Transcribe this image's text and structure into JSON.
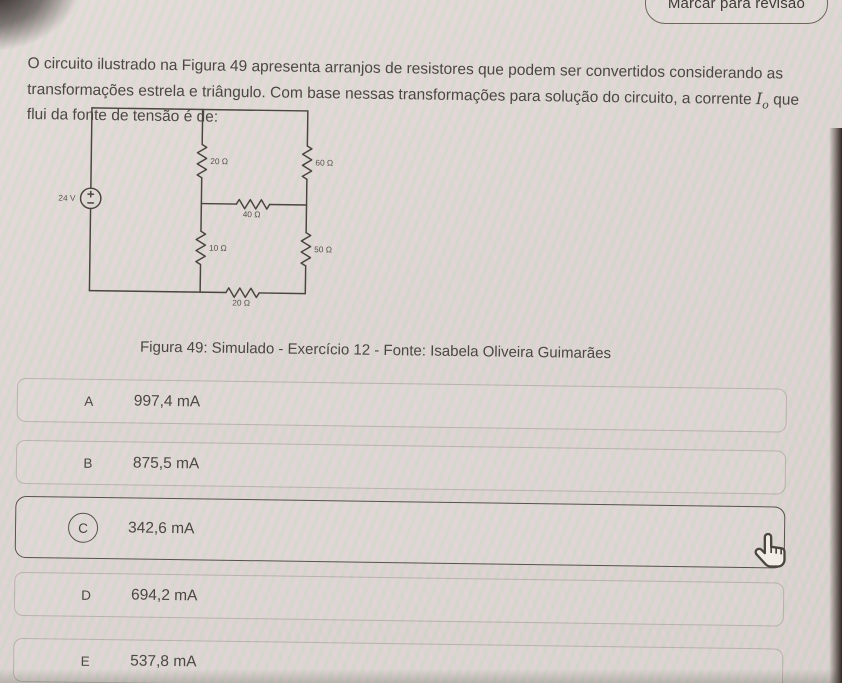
{
  "header": {
    "review_button_label": "Marcar para revisão"
  },
  "question": {
    "text_main": "O circuito ilustrado na Figura 49 apresenta arranjos de resistores que podem ser convertidos considerando as transformações estrela e triângulo. Com base nessas transformações para solução do circuito, a corrente",
    "current_symbol": "I",
    "current_subscript": "o",
    "text_end": "que flui da fonte de tensão é de:"
  },
  "figure": {
    "source_label": "24 V",
    "resistors": {
      "top_middle": "20 Ω",
      "top_right": "60 Ω",
      "middle": "40 Ω",
      "bottom_middle": "10 Ω",
      "bottom_right": "50 Ω",
      "bottom": "20 Ω"
    },
    "caption": "Figura 49: Simulado - Exercício 12 - Fonte: Isabela Oliveira Guimarães"
  },
  "options": [
    {
      "letter": "A",
      "value": "997,4 mA",
      "selected": false
    },
    {
      "letter": "B",
      "value": "875,5 mA",
      "selected": false
    },
    {
      "letter": "C",
      "value": "342,6 mA",
      "selected": true
    },
    {
      "letter": "D",
      "value": "694,2 mA",
      "selected": false
    },
    {
      "letter": "E",
      "value": "537,8 mA",
      "selected": false
    }
  ],
  "colors": {
    "background": "#dcd4d2",
    "text": "#4b4742",
    "selected_border": "#57524c",
    "bezel": "#22180f"
  }
}
